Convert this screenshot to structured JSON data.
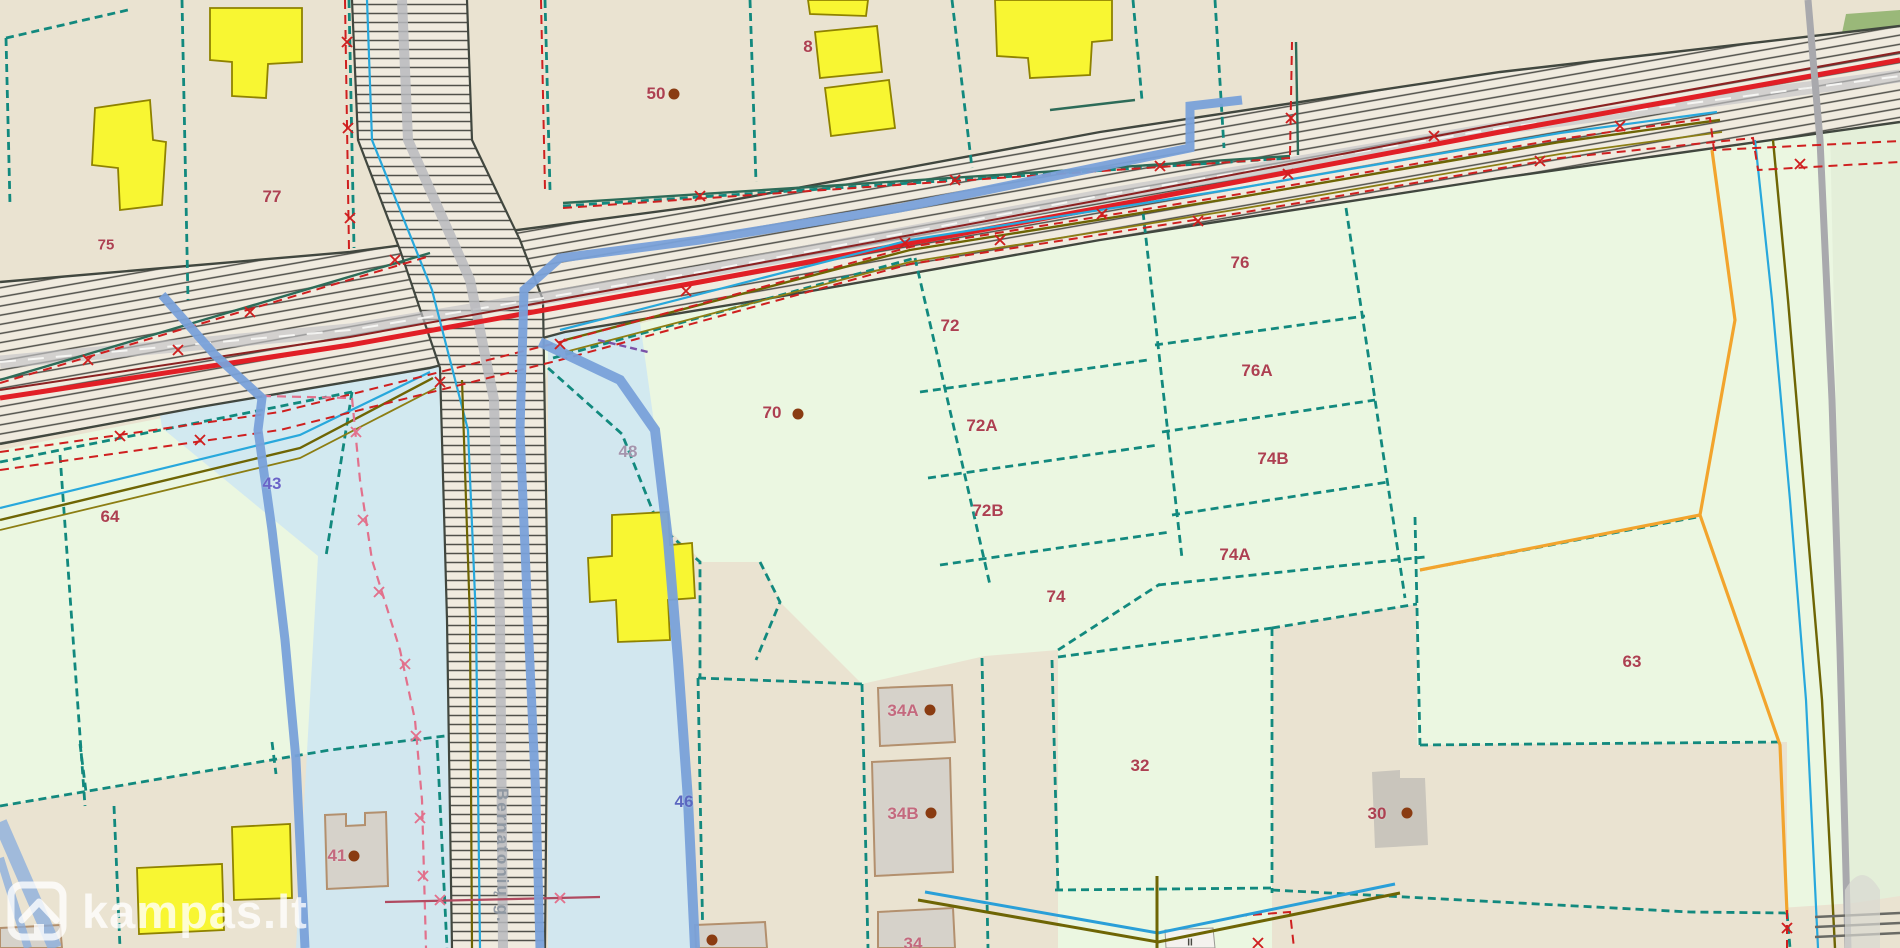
{
  "watermark": {
    "brand": "kampas.lt"
  },
  "street_label": {
    "name": "Bernatonių g."
  },
  "colors": {
    "background_beige": "#eae3d1",
    "parcel_green": "#ebf7e1",
    "protection_zone_blue": "#cfe7f2",
    "road_fill": "#f0ebdf",
    "road_hatch": "#50504a",
    "boundary_teal": "#12897e",
    "boundary_dark": "#2d6b58",
    "pipeline_red": "#e11f26",
    "boundary_red_dashed": "#cf1f1f",
    "stream_blue": "#7aa2da",
    "utility_cyan": "#28a8dc",
    "utility_olive": "#6e6504",
    "utility_orange": "#f2a42d",
    "utility_pink": "#e2718c",
    "building_yellow": "#f8f632",
    "building_gray": "#d6d2ca",
    "parcel_label": "#ad4051",
    "parcel_label_pink": "#c4697e",
    "hydro_label_blue": "#5b67c0",
    "zone_label_gray": "#a595ad",
    "dot_brown": "#8a3c12"
  },
  "labels": [
    {
      "text": "77",
      "x": 272,
      "y": 198
    },
    {
      "text": "75",
      "x": 106,
      "y": 246,
      "fs": 15
    },
    {
      "text": "50",
      "x": 656,
      "y": 95,
      "dot": [
        18,
        -1
      ]
    },
    {
      "text": "8",
      "x": 808,
      "y": 48
    },
    {
      "text": "64",
      "x": 110,
      "y": 518
    },
    {
      "text": "70",
      "x": 772,
      "y": 414,
      "dot": [
        26,
        0
      ]
    },
    {
      "text": "72",
      "x": 950,
      "y": 327
    },
    {
      "text": "72A",
      "x": 982,
      "y": 427
    },
    {
      "text": "72B",
      "x": 988,
      "y": 512
    },
    {
      "text": "74",
      "x": 1056,
      "y": 598
    },
    {
      "text": "74A",
      "x": 1235,
      "y": 556
    },
    {
      "text": "74B",
      "x": 1273,
      "y": 460
    },
    {
      "text": "76",
      "x": 1240,
      "y": 264
    },
    {
      "text": "76A",
      "x": 1257,
      "y": 372
    },
    {
      "text": "63",
      "x": 1632,
      "y": 663
    },
    {
      "text": "32",
      "x": 1140,
      "y": 767
    },
    {
      "text": "30",
      "x": 1377,
      "y": 815,
      "dot": [
        30,
        -2
      ]
    },
    {
      "text": "41",
      "x": 337,
      "y": 857,
      "color": "#c4697e",
      "dot": [
        17,
        -1
      ]
    },
    {
      "text": "34A",
      "x": 903,
      "y": 712,
      "color": "#c4697e",
      "dot": [
        27,
        -2
      ]
    },
    {
      "text": "34B",
      "x": 903,
      "y": 815,
      "color": "#c4697e",
      "dot": [
        28,
        -2
      ]
    },
    {
      "text": "34",
      "x": 913,
      "y": 945,
      "color": "#c4697e"
    },
    {
      "text": "43",
      "x": 272,
      "y": 485,
      "color": "#6a64c8"
    },
    {
      "text": "46",
      "x": 684,
      "y": 803,
      "color": "#5b67c0"
    },
    {
      "text": "48",
      "x": 628,
      "y": 453,
      "color": "#a595ad"
    }
  ],
  "extra_dots": [
    [
      712,
      940
    ]
  ],
  "tiny_labels": [
    {
      "text": "II",
      "x": 1190,
      "y": 943
    }
  ]
}
